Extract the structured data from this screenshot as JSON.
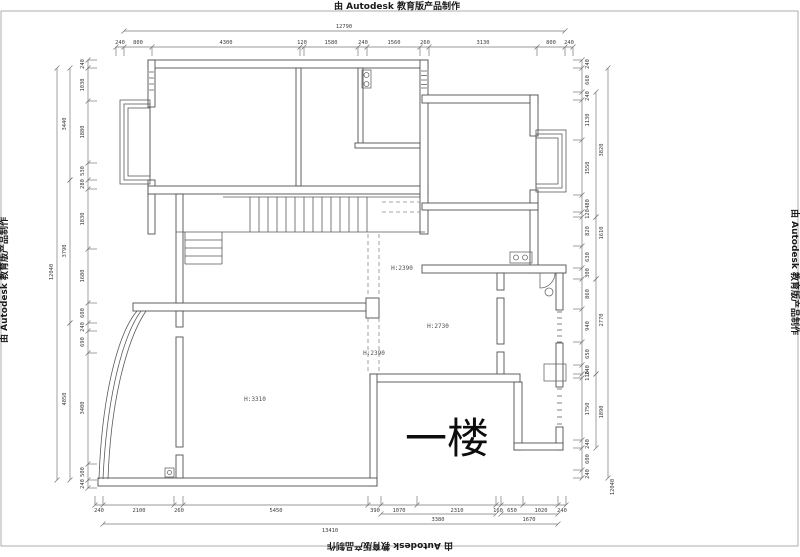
{
  "watermark": {
    "text": "由 Autodesk 教育版产品制作"
  },
  "floor_label": "一楼",
  "room_labels": [
    {
      "text": "H:2390"
    },
    {
      "text": "H:2390"
    },
    {
      "text": "H:2730"
    },
    {
      "text": "H:3310"
    }
  ],
  "dims": {
    "top": {
      "line_y": 47,
      "text_y": 44,
      "ticks": [
        116,
        124,
        152,
        300,
        304,
        358,
        367,
        420,
        429,
        537,
        565,
        573
      ],
      "labels": [
        {
          "t": "240",
          "x": 120
        },
        {
          "t": "800",
          "x": 138
        },
        {
          "t": "4300",
          "x": 226
        },
        {
          "t": "120",
          "x": 302
        },
        {
          "t": "1580",
          "x": 331
        },
        {
          "t": "240",
          "x": 363
        },
        {
          "t": "1560",
          "x": 394
        },
        {
          "t": "260",
          "x": 425
        },
        {
          "t": "3130",
          "x": 483
        },
        {
          "t": "800",
          "x": 551
        },
        {
          "t": "240",
          "x": 569
        }
      ],
      "overall": {
        "t": "12790",
        "x1": 124,
        "x2": 565,
        "line_y": 31,
        "tx": 344,
        "ty": 28
      }
    },
    "bottom": {
      "line_y": 505,
      "text_y": 512,
      "ticks": [
        95,
        103,
        174,
        183,
        368,
        381,
        417,
        496,
        501,
        523,
        558,
        566
      ],
      "labels": [
        {
          "t": "240",
          "x": 99
        },
        {
          "t": "2100",
          "x": 139
        },
        {
          "t": "260",
          "x": 179
        },
        {
          "t": "5450",
          "x": 276
        },
        {
          "t": "390",
          "x": 375
        },
        {
          "t": "1070",
          "x": 399
        },
        {
          "t": "2310",
          "x": 457
        },
        {
          "t": "160",
          "x": 498
        },
        {
          "t": "650",
          "x": 512
        },
        {
          "t": "1020",
          "x": 541
        },
        {
          "t": "240",
          "x": 562
        }
      ],
      "sub": {
        "line_y": 514,
        "text_y": 521,
        "spans": [
          {
            "t": "3380",
            "x1": 381,
            "x2": 496,
            "tx": 438
          },
          {
            "t": "1670",
            "x1": 501,
            "x2": 558,
            "tx": 529
          }
        ]
      },
      "overall": {
        "t": "13410",
        "x1": 103,
        "x2": 558,
        "line_y": 524,
        "tx": 330,
        "ty": 532
      }
    },
    "left": {
      "line_x": 88,
      "text_x": 84,
      "ticks": [
        60,
        68,
        101,
        163,
        180,
        189,
        249,
        303,
        323,
        331,
        353,
        464,
        480,
        488
      ],
      "labels": [
        {
          "t": "240",
          "y": 64
        },
        {
          "t": "1030",
          "y": 85
        },
        {
          "t": "1880",
          "y": 132
        },
        {
          "t": "530",
          "y": 171
        },
        {
          "t": "280",
          "y": 184
        },
        {
          "t": "1830",
          "y": 219
        },
        {
          "t": "1680",
          "y": 276
        },
        {
          "t": "600",
          "y": 313
        },
        {
          "t": "240",
          "y": 327
        },
        {
          "t": "690",
          "y": 342
        },
        {
          "t": "3400",
          "y": 408
        },
        {
          "t": "500",
          "y": 472
        },
        {
          "t": "240",
          "y": 484
        }
      ],
      "sub": {
        "line_x": 70,
        "text_x": 66,
        "spans": [
          {
            "t": "3440",
            "y1": 68,
            "y2": 180,
            "ty": 124
          },
          {
            "t": "3790",
            "y1": 180,
            "y2": 323,
            "ty": 251
          },
          {
            "t": "4850",
            "y1": 323,
            "y2": 480,
            "ty": 399
          }
        ]
      },
      "overall": {
        "t": "12040",
        "line_x": 57,
        "text_x": 53,
        "y1": 68,
        "y2": 480,
        "ty": 272
      }
    },
    "right": {
      "line_x": 582,
      "text_x": 589,
      "ticks": [
        60,
        68,
        92,
        100,
        140,
        195,
        212,
        217,
        246,
        268,
        279,
        309,
        342,
        365,
        374,
        378,
        440,
        448,
        470,
        478
      ],
      "labels": [
        {
          "t": "240",
          "y": 64
        },
        {
          "t": "660",
          "y": 80
        },
        {
          "t": "240",
          "y": 96
        },
        {
          "t": "1130",
          "y": 120
        },
        {
          "t": "1550",
          "y": 168
        },
        {
          "t": "480",
          "y": 204
        },
        {
          "t": "120",
          "y": 214
        },
        {
          "t": "820",
          "y": 231
        },
        {
          "t": "630",
          "y": 257
        },
        {
          "t": "300",
          "y": 273
        },
        {
          "t": "860",
          "y": 294
        },
        {
          "t": "940",
          "y": 326
        },
        {
          "t": "650",
          "y": 354
        },
        {
          "t": "240",
          "y": 370
        },
        {
          "t": "110",
          "y": 376
        },
        {
          "t": "1750",
          "y": 409
        },
        {
          "t": "240",
          "y": 444
        },
        {
          "t": "600",
          "y": 459
        },
        {
          "t": "240",
          "y": 474
        }
      ],
      "sub": {
        "line_x": 596,
        "text_x": 603,
        "spans": [
          {
            "t": "3820",
            "y1": 92,
            "y2": 217,
            "ty": 150
          },
          {
            "t": "1610",
            "y1": 217,
            "y2": 279,
            "ty": 233
          },
          {
            "t": "2770",
            "y1": 279,
            "y2": 374,
            "ty": 320
          },
          {
            "t": "1890",
            "y1": 374,
            "y2": 448,
            "ty": 412
          }
        ]
      },
      "overall": {
        "t": "12040",
        "line_x": 608,
        "text_x": 614,
        "y1": 68,
        "y2": 478,
        "ty": 487
      }
    }
  }
}
